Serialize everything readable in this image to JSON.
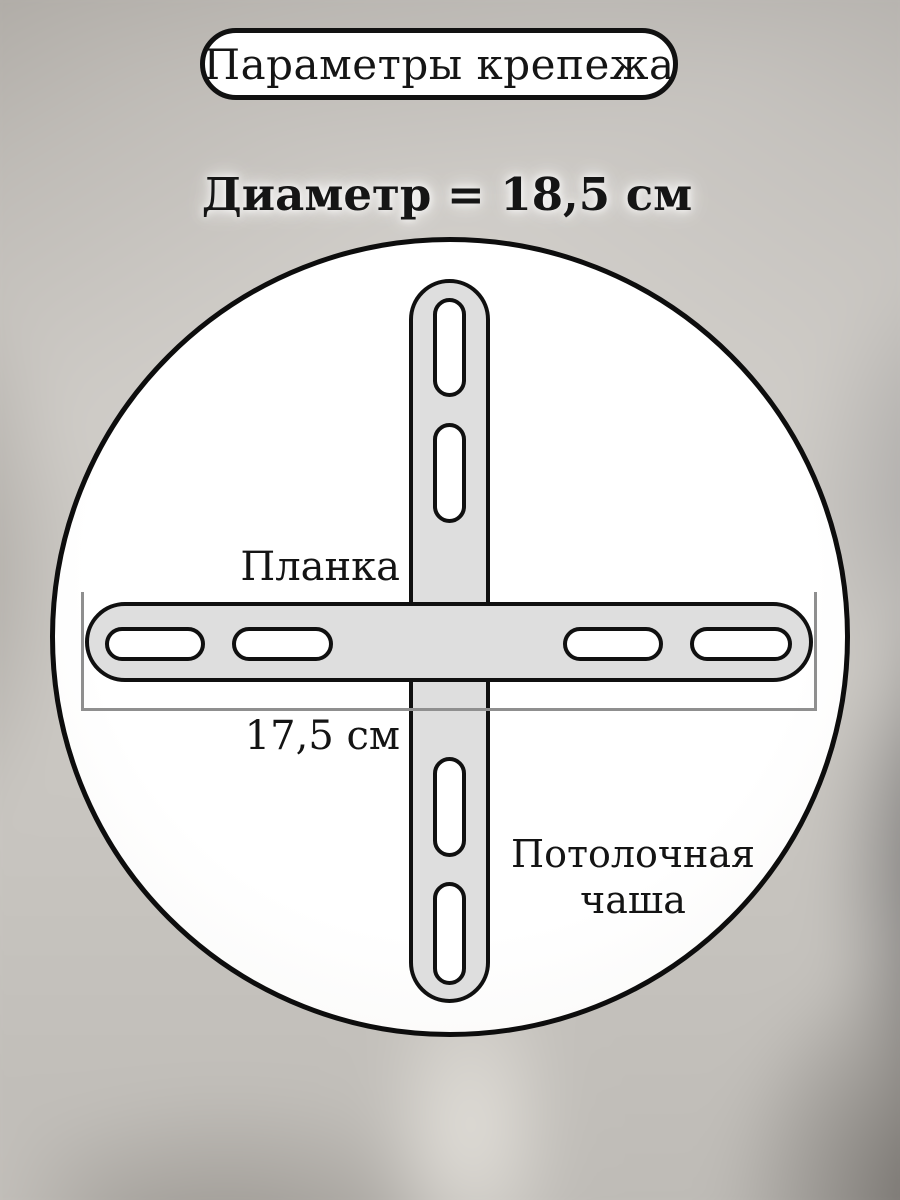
{
  "title": {
    "label": "Параметры крепежа"
  },
  "diameter": {
    "label": "Диаметр = 18,5 см",
    "value_cm": "18,5"
  },
  "diagram": {
    "strip": {
      "label": "Планка"
    },
    "strip_length": {
      "label": "17,5 см",
      "value_cm": "17,5"
    },
    "cup": {
      "line1": "Потолочная",
      "line2": "чаша"
    },
    "colors": {
      "outline": "#101010",
      "bar_fill": "#dedede",
      "slot_fill": "#ffffff",
      "circle_fill": "#ffffff",
      "dimension_line": "#8f8f8f"
    }
  }
}
